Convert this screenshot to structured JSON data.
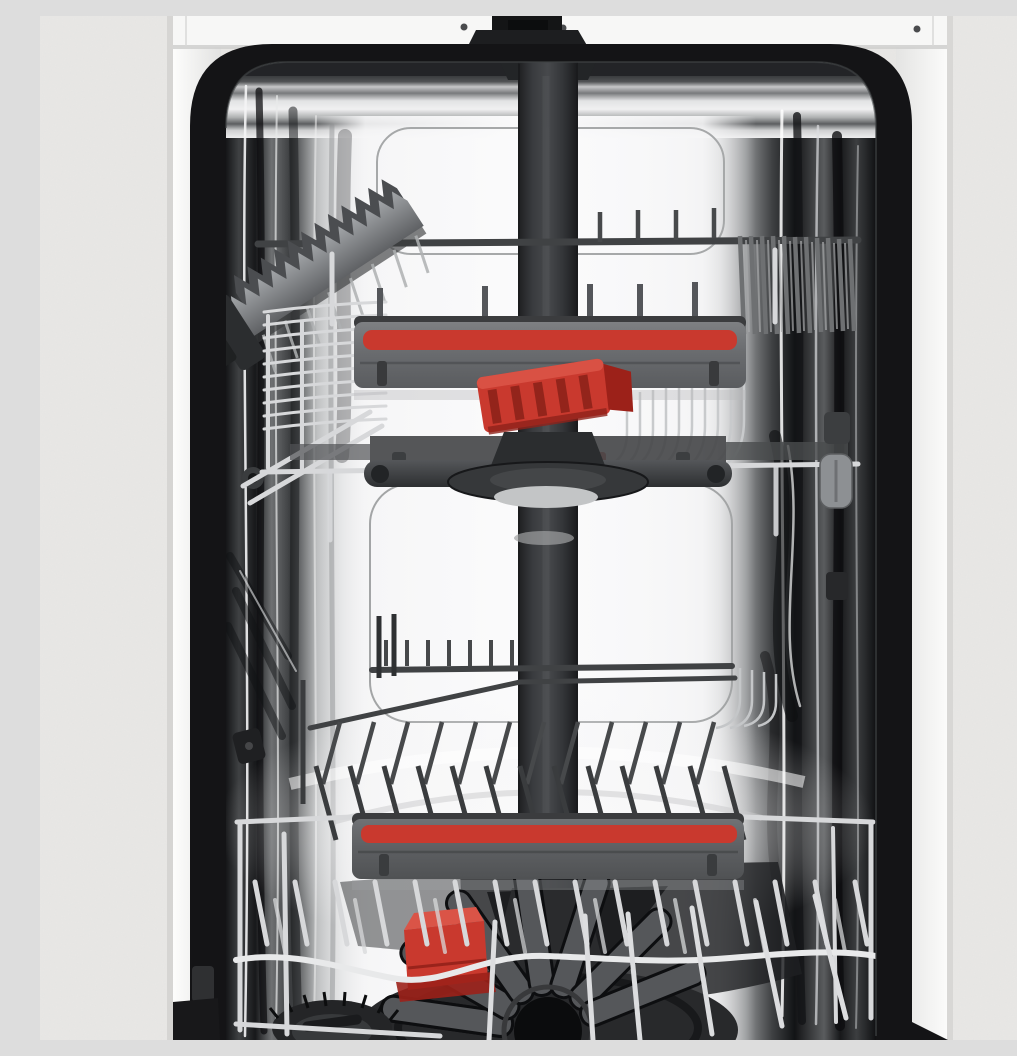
{
  "scene": {
    "type": "product-photo",
    "description": "Open slimline dishwasher seen from the front: empty stainless-steel tub with two pull-out wire baskets, each with a grey handle bar carrying a red accent stripe, a fold-out knife rack in the upper basket, a red folding cup shelf, a mid-level spray arm on a central dark water column, a lower spray arm, a red rinse-aid cap and a round salt cap on the tub floor, framed by a black door seal and white cabinet panels against a light grey wall"
  },
  "palette": {
    "wall": "#e9e8e6",
    "cabinet_white": "#f7f7f6",
    "cabinet_shadow": "#d6d5d3",
    "frame_black": "#141416",
    "steel_bright": "#f3f3f4",
    "steel_mid": "#9a9c9e",
    "steel_dark": "#2c2d2f",
    "rack_wire_silver": "#d7d8da",
    "rack_wire_dark": "#404244",
    "handle_gray": "#6f7174",
    "handle_edge": "#3b3c3e",
    "red_accent": "#c9392e",
    "red_bright": "#da5447",
    "red_dark": "#9c2119",
    "arm_dark": "#232527",
    "column_gray": "#3f4143",
    "knife_gray": "#85888b"
  },
  "parts": {
    "tub": "Stainless steel tub interior",
    "door_frame": "Black door opening frame with seal",
    "water_column": "Central water supply duct",
    "upper_basket": "Upper basket",
    "upper_handle": "Upper basket handle with red accent stripe",
    "knife_rack": "Fold-out knife and utensil rack",
    "red_shelf": "Red folding cup shelf",
    "middle_spray_arm": "Mid-level spray arm",
    "lower_basket": "Lower basket",
    "lower_handle": "Lower basket handle with red accent stripe",
    "lower_spray_arm": "Lower spray arm",
    "detergent_cap": "Red rinse-aid cap",
    "salt_cap": "Round salt reservoir cap",
    "water_inlet": "Top water inlet fitting"
  }
}
